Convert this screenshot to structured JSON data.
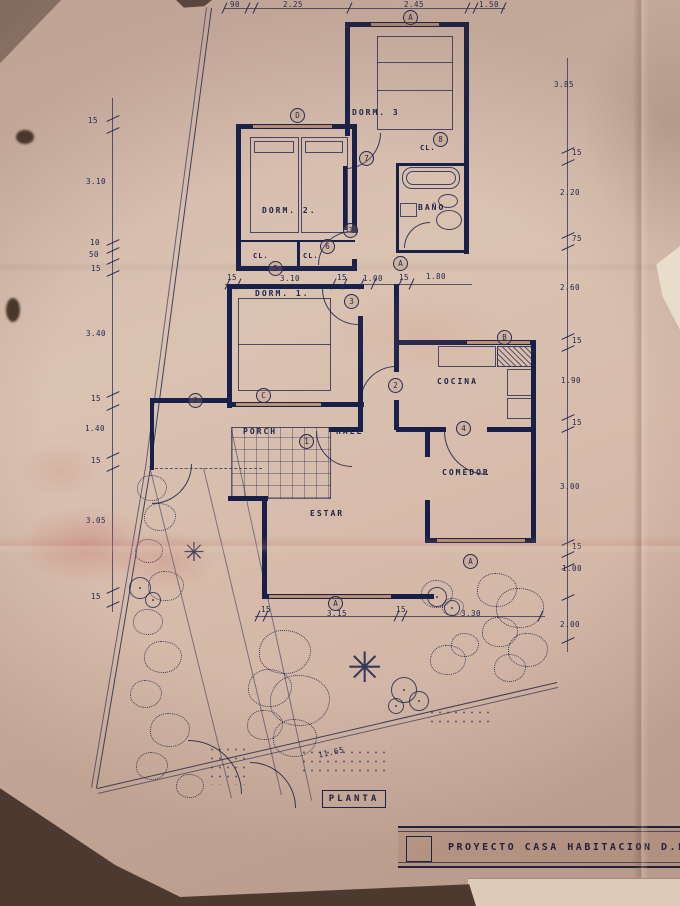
{
  "sheet": {
    "plan_label": "PLANTA",
    "diagonal_dim": "11.65"
  },
  "title_block": {
    "text": "PROYECTO CASA HABITACION D.F.L. N"
  },
  "rooms": {
    "dorm3": "DORM. 3",
    "dorm2": "DORM. 2.",
    "dorm1": "DORM. 1.",
    "bano": "BAÑO",
    "cocina": "COCINA",
    "comedor": "COMEDOR",
    "estar": "ESTAR",
    "porch": "PORCH",
    "hall": "HALL"
  },
  "closets": [
    "CL.",
    "CL.",
    "CL."
  ],
  "dims": {
    "top": [
      "90",
      "2.25",
      "2.45",
      "1.50"
    ],
    "left": [
      "15",
      "3.10",
      "10",
      "50",
      "15",
      "3.40",
      "15",
      "1.40",
      "15",
      "3.05",
      "15"
    ],
    "right": [
      "3.85",
      "15",
      "2.20",
      "75",
      "2.60",
      "15",
      "1.90",
      "15",
      "3.00",
      "15",
      "1.00",
      "2.00"
    ],
    "middle": [
      "15",
      "3.10",
      "15",
      "1.00",
      "15",
      "1.80"
    ],
    "bottom": [
      "15",
      "3.15",
      "15",
      "3.30"
    ]
  },
  "markers": [
    "A",
    "D",
    "7",
    "8",
    "3",
    "6",
    "5",
    "3",
    "A",
    "2",
    "C",
    "1",
    "4",
    "B",
    "2",
    "A",
    "A"
  ],
  "colors": {
    "ink": "#1c2a6a",
    "paper": "#d6bbaa"
  }
}
